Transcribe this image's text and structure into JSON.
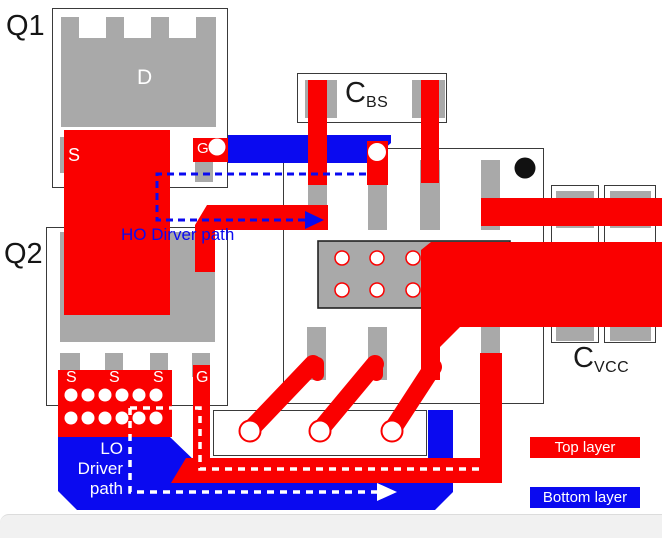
{
  "labels": {
    "q1": "Q1",
    "q2": "Q2",
    "drain": "D",
    "source": "S",
    "gate": "G",
    "cbs_main": "C",
    "cbs_sub": "BS",
    "cvcc_main": "C",
    "cvcc_sub": "VCC",
    "ho_path": "HO Dirver path",
    "lo_line1": "LO",
    "lo_line2": "Driver",
    "lo_line3": "path"
  },
  "legend": {
    "top": "Top layer",
    "bottom": "Bottom layer"
  },
  "colors": {
    "top_layer_red": "#fa0000",
    "bottom_layer_blue": "#0a0af0",
    "pad_gray": "#a9a9a9",
    "outline": "#3a3a3a",
    "pin1_marker": "#111111",
    "via_hole": "#ffffff",
    "footer_bg": "#f1f1f1"
  }
}
